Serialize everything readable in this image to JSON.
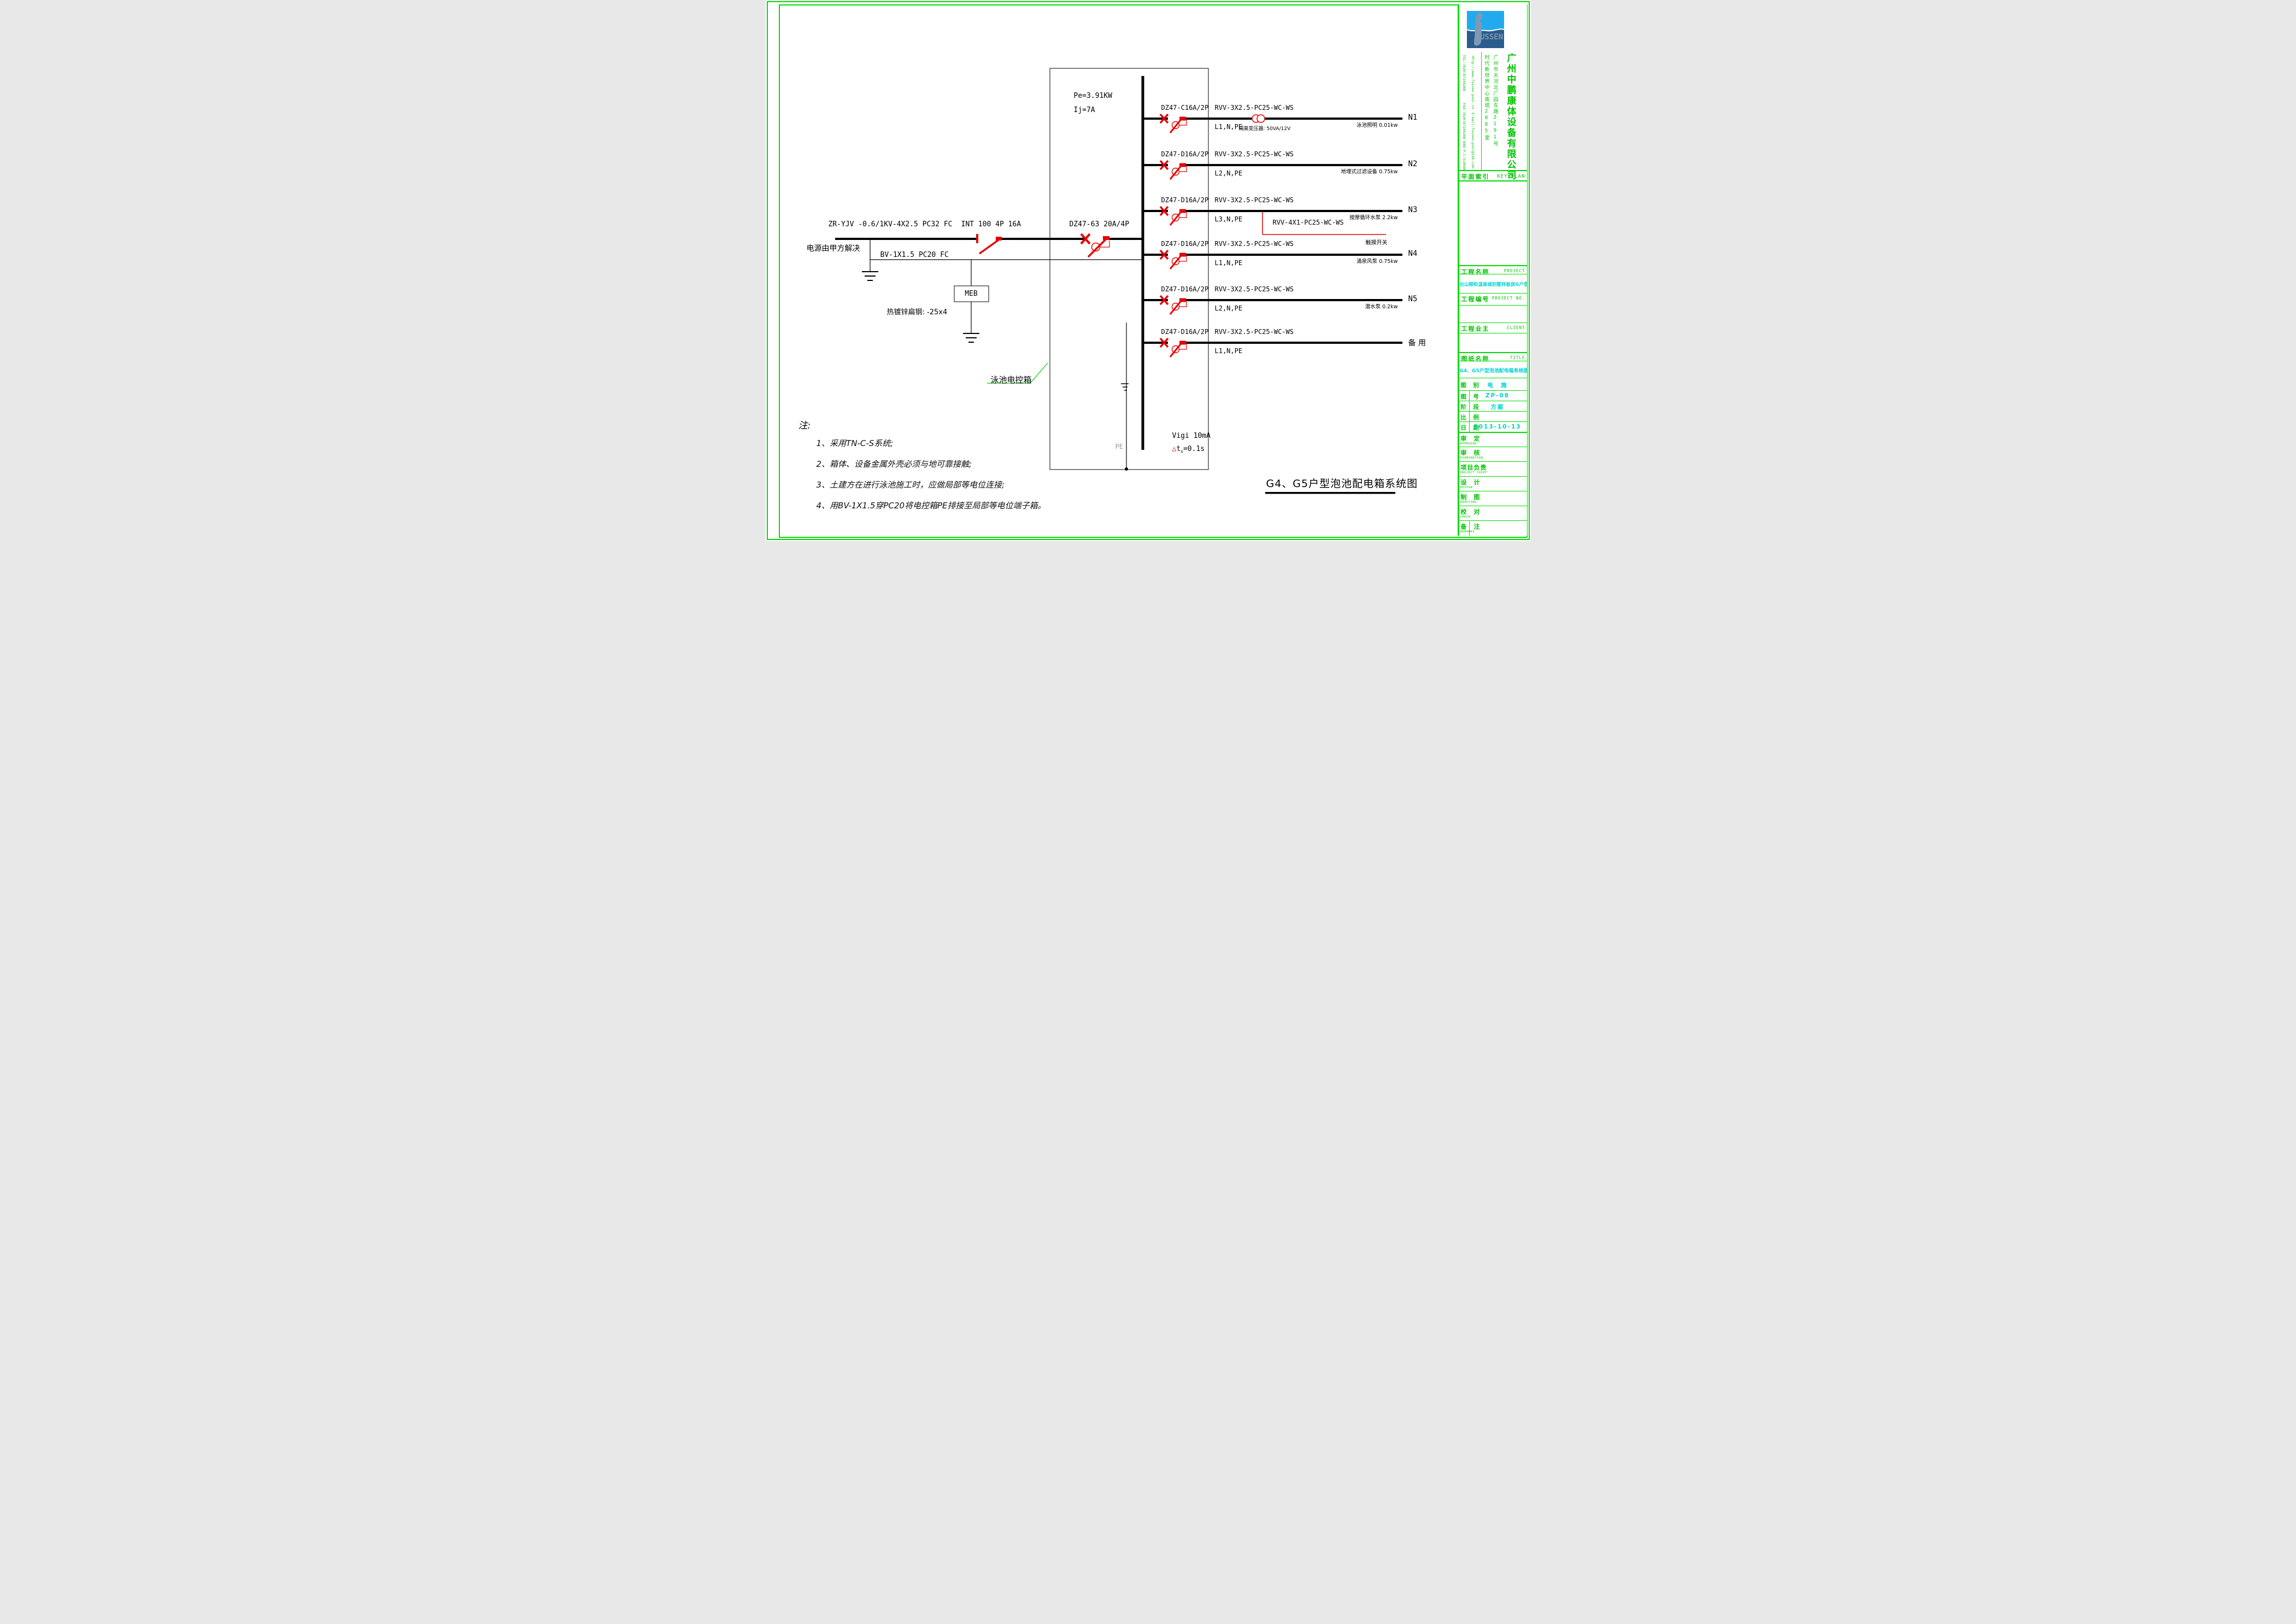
{
  "colors": {
    "frame_green": "#00dd00",
    "text_green": "#00c400",
    "text_cyan": "#00d2d2",
    "symbol_red": "#e60000",
    "logo_light_blue": "#22aaee",
    "logo_dark_blue": "#2a5c8e",
    "logo_gray": "#8095a8"
  },
  "logo": {
    "text": "USSEN",
    "figure_icon": "swimmer-silhouette"
  },
  "company": {
    "name": "广州中鹏康体设备有限公司",
    "address_line1": "广州市天河北广园东路2191号",
    "address_line2": "时代新世界中心南塔2885室",
    "website": "Http://www.fussen-pool.cn",
    "tel": "TEL:(020)87244208",
    "fax": "FAX:(020)87244208-608",
    "email": "E-mail:fussen-pool@126.com",
    "postcode": "P.C:510500"
  },
  "title_block": {
    "key_plan_cn": "平面索引",
    "key_plan_en": "KEY PLAN",
    "project_label_cn": "工程名称",
    "project_label_en": "PROJECT",
    "project_name": "台山颐和温泉城别墅样板房G户型泡池",
    "project_no_cn": "工程编号",
    "project_no_en": "PROJECT NO.",
    "project_no_value": "",
    "client_cn": "工程业主",
    "client_en": "CLIENT",
    "client_value": "",
    "title_label_cn": "图纸名称",
    "title_label_en": "TITLE",
    "drawing_title": "G4、G5户型泡池配电箱系统图",
    "attributes": [
      {
        "label": "图　别",
        "value": "电　施"
      },
      {
        "label": "图　号",
        "value": "ZP-08"
      },
      {
        "label": "阶　段",
        "value": "方案"
      },
      {
        "label": "比　例",
        "value": ""
      },
      {
        "label": "日　期",
        "value": "2013-10-13"
      }
    ],
    "signatures": [
      {
        "cn": "审　定",
        "en": "APPROVED"
      },
      {
        "cn": "审　核",
        "en": "EXAMINATION"
      },
      {
        "cn": "项目负责",
        "en": "PROJECT CHIEF"
      },
      {
        "cn": "设　计",
        "en": "DESIGN"
      },
      {
        "cn": "制　图",
        "en": "DRAFTING"
      },
      {
        "cn": "校　对",
        "en": "CHECK"
      },
      {
        "cn": "备　注",
        "en": "REMARKS"
      }
    ]
  },
  "drawing": {
    "source_cable": "ZR-YJV -0.6/1KV-4X2.5 PC32  FC",
    "source_note": "电源由甲方解决",
    "pe_bond_cable": "BV-1X1.5 PC20 FC",
    "meb_label": "MEB",
    "earth_strip": "热镀锌扁钢: -25x4",
    "isolator": "INT 100 4P 16A",
    "main_breaker": "DZ47-63 20A/4P",
    "power": "Pe=3.91KW",
    "current": "Ij=7A",
    "box_label": "泳池电控箱",
    "pe_label": "PE",
    "rcd_line1": "Vigi  10mA",
    "rcd_tri": "△",
    "rcd_t": "t",
    "rcd_sub": "s",
    "rcd_eq": "=0.1s",
    "diagram_title": "G4、G5户型泡池配电箱系统图",
    "branches": [
      {
        "id": "N1",
        "breaker": "DZ47-C16A/2P",
        "cable": "RVV-3X2.5-PC25-WC-WS",
        "phases": "L1,N,PE",
        "load": "泳池照明 0.01kw",
        "transformer": "隔离变压器: 50VA/12V"
      },
      {
        "id": "N2",
        "breaker": "DZ47-D16A/2P",
        "cable": "RVV-3X2.5-PC25-WC-WS",
        "phases": "L2,N,PE",
        "load": "地埋式过滤设备 0.75kw"
      },
      {
        "id": "N3",
        "breaker": "DZ47-D16A/2P",
        "cable": "RVV-3X2.5-PC25-WC-WS",
        "phases": "L3,N,PE",
        "load": "按摩循环水泵 2.2kw",
        "tap_cable": "RVV-4X1-PC25-WC-WS",
        "tap_load": "触摸开关"
      },
      {
        "id": "N4",
        "breaker": "DZ47-D16A/2P",
        "cable": "RVV-3X2.5-PC25-WC-WS",
        "phases": "L1,N,PE",
        "load": "涌泉风泵 0.75kw"
      },
      {
        "id": "N5",
        "breaker": "DZ47-D16A/2P",
        "cable": "RVV-3X2.5-PC25-WC-WS",
        "phases": "L2,N,PE",
        "load": "潜水泵 0.2kw"
      },
      {
        "id": "备 用",
        "breaker": "DZ47-D16A/2P",
        "cable": "RVV-3X2.5-PC25-WC-WS",
        "phases": "L1,N,PE",
        "load": ""
      }
    ],
    "notes_title": "注:",
    "notes": [
      "1、采用TN-C-S系统;",
      "2、箱体、设备金属外壳必须与地可靠接触;",
      "3、土建方在进行泳池施工时，应做局部等电位连接;",
      "4、用BV-1X1.5穿PC20将电控箱PE排接至局部等电位端子箱。"
    ]
  }
}
